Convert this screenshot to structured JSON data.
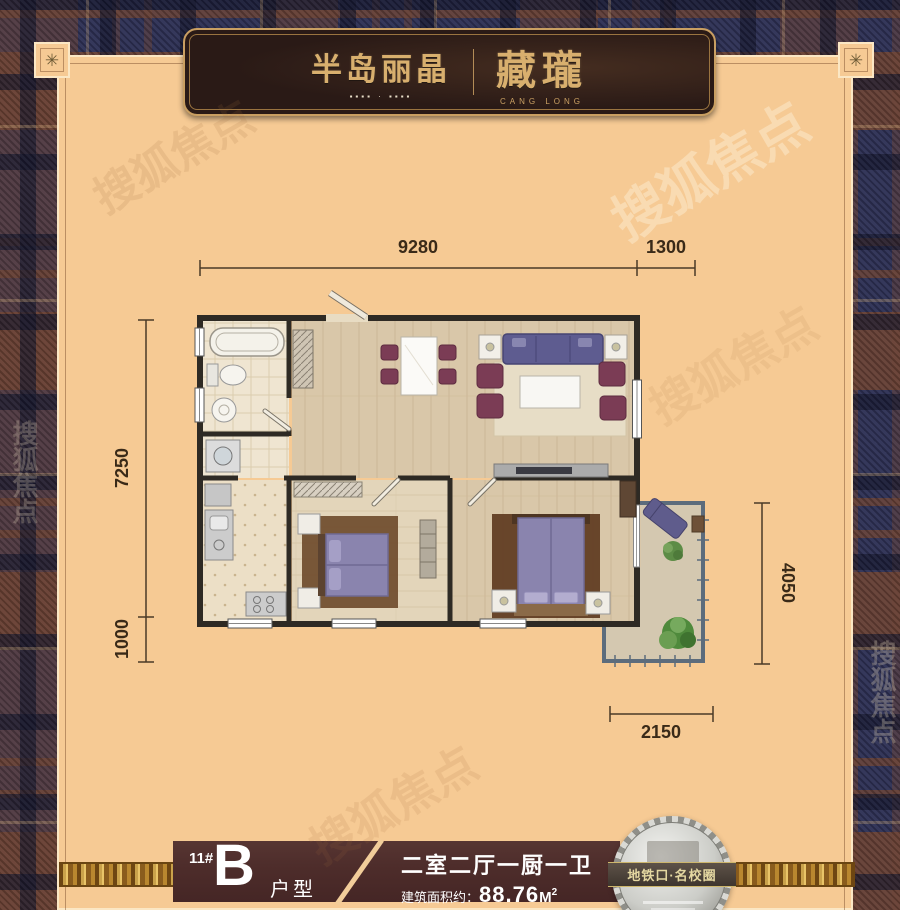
{
  "header": {
    "logo_left": "半岛丽晶",
    "logo_left_sub": "▪▪▪▪ · ▪▪▪▪",
    "logo_right": "藏瓏",
    "logo_right_sub": "CANG LONG"
  },
  "plan": {
    "dimensions": {
      "top_width": "9280",
      "top_right_width": "1300",
      "left_height": "7250",
      "left_bottom_height": "1000",
      "right_height": "4050",
      "bottom_width": "2150"
    }
  },
  "footer": {
    "building_number": "11#",
    "unit_letter": "B",
    "unit_type_label": "户型",
    "layout_text": "二室二厅一厨一卫",
    "area_label": "建筑面积约：",
    "area_value": "88.76",
    "area_unit": "M",
    "area_superscript": "2"
  },
  "badge": {
    "text": "地铁口·名校圈"
  },
  "watermark": {
    "text": "搜狐焦点"
  },
  "corner_ornament": "✳",
  "colors": {
    "panel": "#f6ca94",
    "plaid_navy": "#2d3054",
    "plaid_brown": "#6a4031",
    "plaque_bg": "#2a1a16",
    "gold": "#c99f62",
    "footer_bar": "#4e2d2b",
    "sofa_purple": "#5e5c90",
    "chair_maroon": "#7b3c55",
    "bed_purple": "#8a84ae",
    "dimension_text": "#3a2a18"
  }
}
